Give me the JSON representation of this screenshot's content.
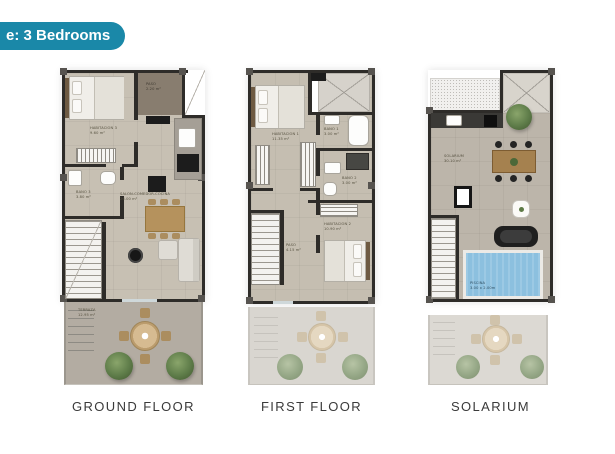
{
  "badge": {
    "label": "e: 3 Bedrooms",
    "color": "#1a88a8"
  },
  "colors": {
    "wall": "#2e2c29",
    "floor": "#c7c0b3",
    "pool": "#8cc0df",
    "terrace": "#b3aca2"
  },
  "plans": [
    {
      "caption": "GROUND FLOOR",
      "rooms": {
        "paso": {
          "label": "PASO",
          "area": "2.20 m²"
        },
        "habitacion3": {
          "label": "HABITACIÓN 3",
          "area": "9.60 m²"
        },
        "bano3": {
          "label": "BAÑO 3",
          "area": "3.80 m²"
        },
        "salon": {
          "label": "SALÓN-COMEDOR-COCINA",
          "area": "26.00 m²"
        },
        "terraza": {
          "label": "TERRAZA",
          "area": "12.95 m²"
        }
      }
    },
    {
      "caption": "FIRST FLOOR",
      "rooms": {
        "habitacion1": {
          "label": "HABITACIÓN 1",
          "area": "11.35 m²"
        },
        "bano1": {
          "label": "BAÑO 1",
          "area": "3.00 m²"
        },
        "bano2": {
          "label": "BAÑO 2",
          "area": "3.00 m²"
        },
        "paso": {
          "label": "PASO",
          "area": "4.15 m²"
        },
        "habitacion2": {
          "label": "HABITACIÓN 2",
          "area": "10.90 m²"
        }
      }
    },
    {
      "caption": "SOLARIUM",
      "rooms": {
        "solarium": {
          "label": "SOLARIUM",
          "area": "30.10 m²"
        },
        "piscina": {
          "label": "PISCINA",
          "area": "3.00 x 2.00m"
        }
      }
    }
  ]
}
